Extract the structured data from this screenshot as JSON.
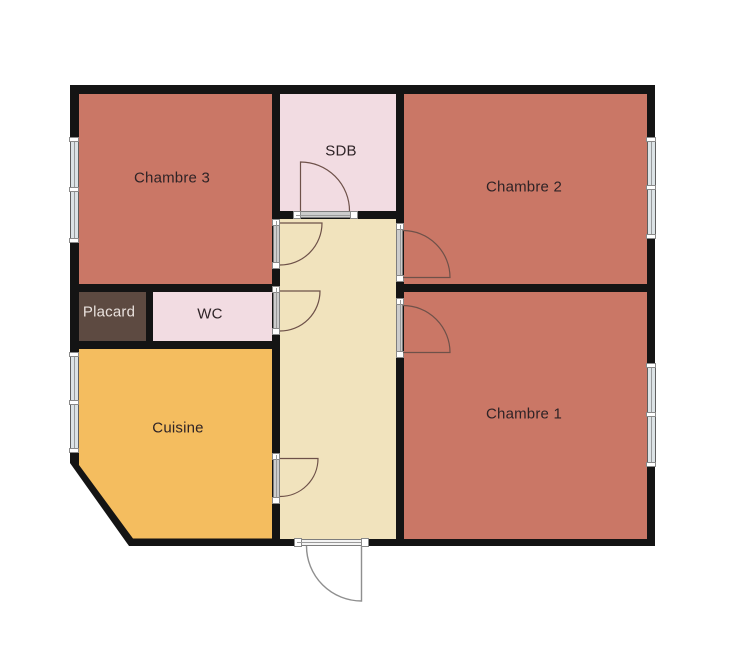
{
  "plan": {
    "rooms": [
      {
        "name": "chambre-3",
        "label": "Chambre 3",
        "color": "#ca7766",
        "label_color": "#2e2326"
      },
      {
        "name": "sdb",
        "label": "SDB",
        "color": "#f2dce2",
        "label_color": "#2e2326"
      },
      {
        "name": "chambre-2",
        "label": "Chambre 2",
        "color": "#ca7766",
        "label_color": "#2e2326"
      },
      {
        "name": "chambre-1",
        "label": "Chambre 1",
        "color": "#ca7766",
        "label_color": "#2e2326"
      },
      {
        "name": "placard",
        "label": "Placard",
        "color": "#5d4a41",
        "label_color": "#e9e1dd"
      },
      {
        "name": "wc",
        "label": "WC",
        "color": "#f2dce2",
        "label_color": "#2e2326"
      },
      {
        "name": "cuisine",
        "label": "Cuisine",
        "color": "#f4bd5f",
        "label_color": "#2e2326"
      },
      {
        "name": "couloir",
        "label": "",
        "color": "#f1e3bd",
        "label_color": "#2e2326"
      }
    ],
    "colors": {
      "background": "#ffffff",
      "wall": "#141414",
      "door_swing": "#6e5149",
      "entry_door": "#8f8f8f",
      "window_fill": "#dce3e6",
      "window_frame": "#5f5f5f",
      "threshold_fill": "#cccccc",
      "threshold_frame": "#7d7d7d"
    }
  }
}
